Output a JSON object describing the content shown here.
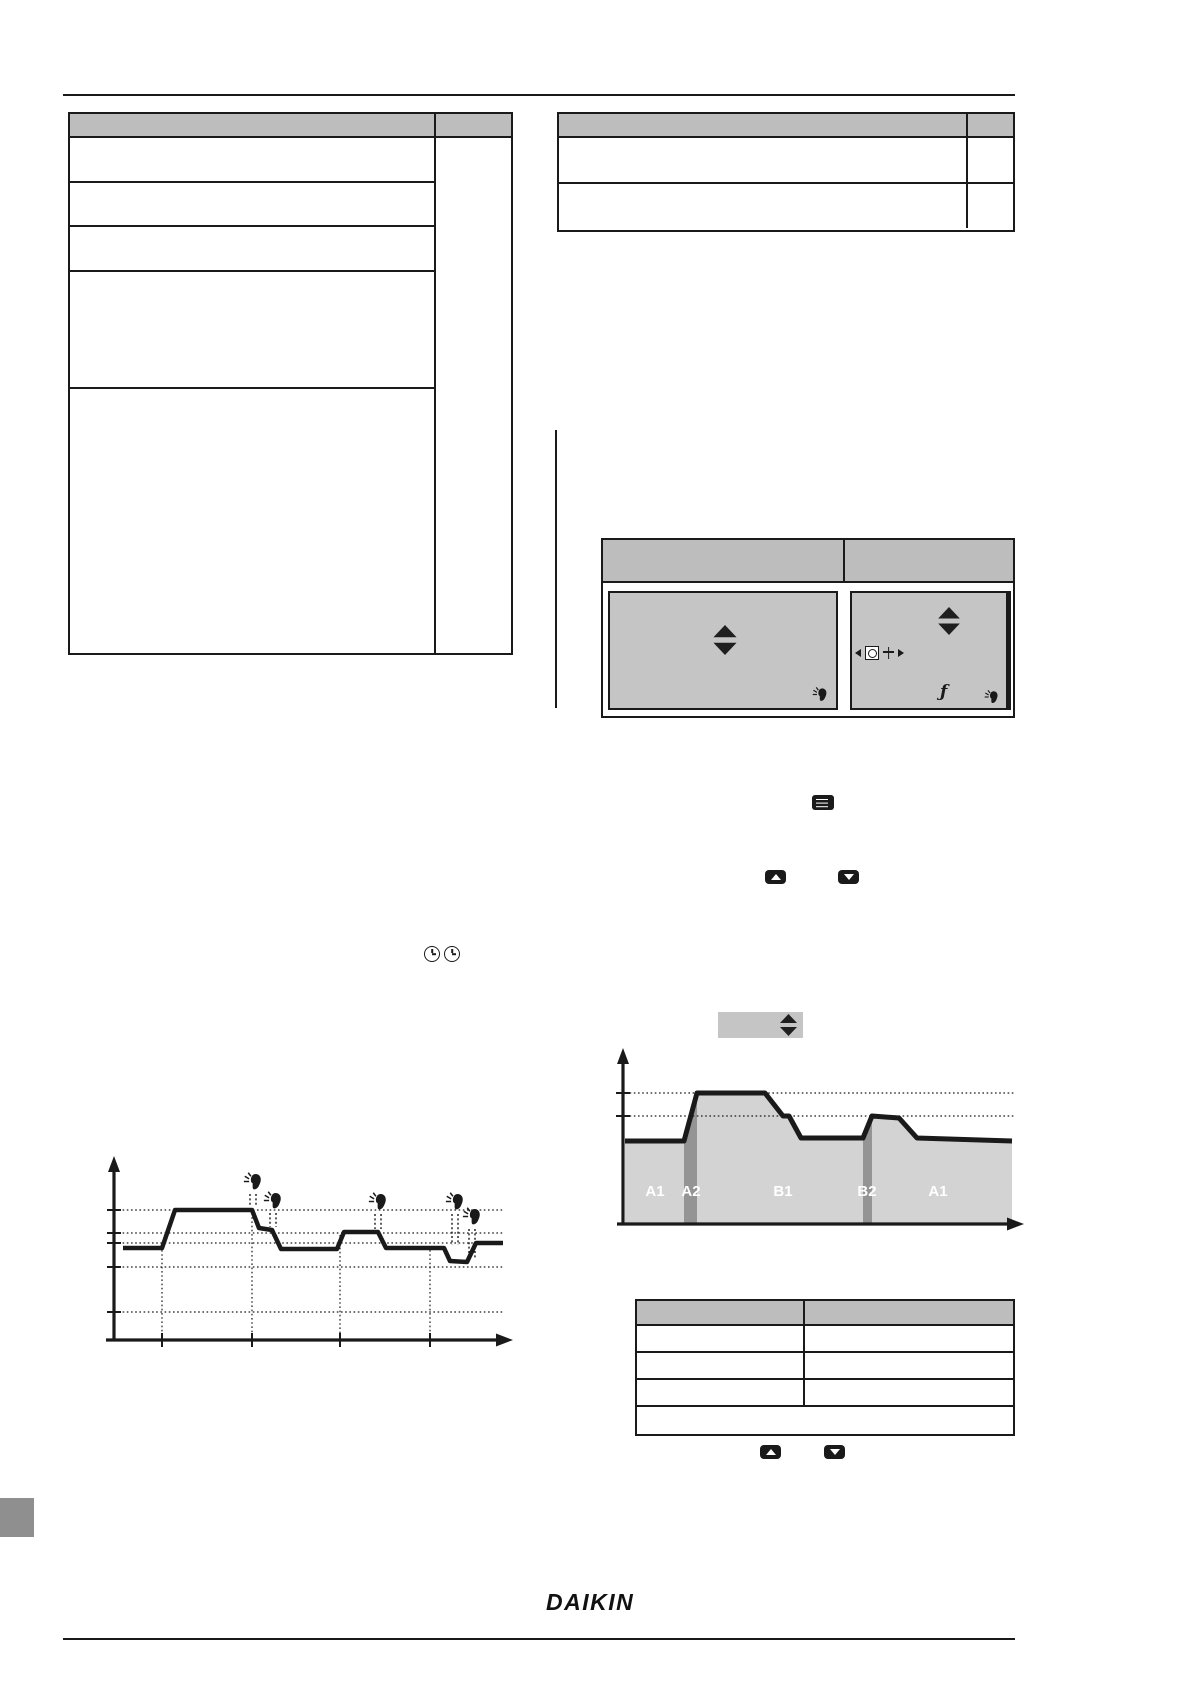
{
  "document": {
    "kind": "operation-manual-page",
    "note": "body text is rendered invisible in the source scan; only frames, figures and icons are visible"
  },
  "colors": {
    "ink": "#1a1a1a",
    "table_header": "#bdbdbd",
    "screen_gray": "#c5c5c5",
    "chart_fill": "#d3d3d3",
    "band_gray": "#949494",
    "white": "#ffffff",
    "thumb_gray": "#8f8f8f"
  },
  "footer": {
    "logo": "DAIKIN"
  },
  "icons": {
    "function_glyph": "ƒ",
    "names": [
      "hand-press-icon",
      "up-down-arrows-icon",
      "up-button-icon",
      "down-button-icon",
      "menu-button-icon",
      "clock-icon",
      "clock-box-icon",
      "program-icon",
      "left-triangle-icon",
      "right-triangle-icon"
    ]
  },
  "tables": {
    "top_left": {
      "columns": 2,
      "left_col_rows": 5,
      "right_col_rows": 1,
      "cells_empty": true
    },
    "top_right": {
      "columns": 2,
      "rows": 2,
      "cells_empty": true
    },
    "screen_figures": {
      "columns": 2,
      "rows": 1,
      "cells_empty": true
    },
    "bottom_right": {
      "columns": 2,
      "rows": 4,
      "cells_empty": true
    }
  },
  "chart_data": [
    {
      "type": "line",
      "name": "room-temperature-schedule-with-manual-overrides",
      "title": "",
      "xlabel": "time",
      "ylabel": "temperature",
      "annotations": "5 hand-press override events with dashed stems down to the curve",
      "grid": "dotted horizontal levels and dotted vertical time marks",
      "geometry": {
        "y_axis": {
          "x": 114,
          "y1": 1156,
          "y2": 1341
        },
        "x_axis": {
          "y": 1340,
          "x1": 106,
          "x2": 513
        },
        "dh_x1": 110,
        "dh_x2": 503,
        "dotted_h": [
          1210,
          1233,
          1243,
          1267,
          1312
        ],
        "ticks_y": [
          1210,
          1233,
          1243,
          1267,
          1312
        ],
        "dotted_v": [
          {
            "x": 162,
            "y1": 1250
          },
          {
            "x": 252,
            "y1": 1213
          },
          {
            "x": 340,
            "y1": 1235
          },
          {
            "x": 430,
            "y1": 1250
          }
        ],
        "ticks_x": [
          162,
          252,
          340,
          430
        ],
        "curve_w": 4.5,
        "curve": [
          [
            123,
            1248
          ],
          [
            162,
            1248
          ],
          [
            175,
            1210
          ],
          [
            252,
            1210
          ],
          [
            259,
            1228
          ],
          [
            272,
            1230
          ],
          [
            281,
            1249
          ],
          [
            337,
            1249
          ],
          [
            344,
            1232
          ],
          [
            378,
            1232
          ],
          [
            386,
            1248
          ],
          [
            444,
            1248
          ],
          [
            450,
            1261
          ],
          [
            467,
            1262
          ],
          [
            476,
            1243
          ],
          [
            503,
            1243
          ]
        ],
        "hands": [
          {
            "x": 253,
            "y": 1182,
            "s1": 1194,
            "s2": 1207
          },
          {
            "x": 273,
            "y": 1201,
            "s1": 1213,
            "s2": 1227
          },
          {
            "x": 378,
            "y": 1202,
            "s1": 1214,
            "s2": 1229
          },
          {
            "x": 455,
            "y": 1202,
            "s1": 1214,
            "s2": 1245
          },
          {
            "x": 472,
            "y": 1217,
            "s1": 1229,
            "s2": 1258
          }
        ]
      }
    },
    {
      "type": "area",
      "name": "schedule-zones-profile",
      "title": "",
      "xlabel": "time",
      "ylabel": "temperature",
      "categories": [
        "A1",
        "A2",
        "B1",
        "B2",
        "A1"
      ],
      "grid": "two dotted setpoint levels",
      "geometry": {
        "box": {
          "x": 718,
          "y": 1012,
          "w": 85,
          "h": 26,
          "ax": 780,
          "ay": 1014
        },
        "y_axis": {
          "x": 623,
          "y1": 1048,
          "y2": 1225
        },
        "x_axis": {
          "y": 1224,
          "x1": 617,
          "x2": 1024
        },
        "dh_x1": 617,
        "dh_x2": 1016,
        "dotted_h": [
          1093,
          1116
        ],
        "ticks_y": [
          1093,
          1116
        ],
        "label_y": 1196,
        "fill": [
          [
            625,
            1141
          ],
          [
            684,
            1141
          ],
          [
            697,
            1093
          ],
          [
            765,
            1093
          ],
          [
            783,
            1116
          ],
          [
            789,
            1116
          ],
          [
            801,
            1138
          ],
          [
            863,
            1138
          ],
          [
            872,
            1116
          ],
          [
            899,
            1118
          ],
          [
            917,
            1138
          ],
          [
            1012,
            1141
          ],
          [
            1012,
            1223
          ],
          [
            625,
            1223
          ]
        ],
        "bands": [
          [
            [
              684,
              1141
            ],
            [
              697,
              1093
            ],
            [
              697,
              1223
            ],
            [
              684,
              1223
            ]
          ],
          [
            [
              863,
              1138
            ],
            [
              872,
              1116
            ],
            [
              872,
              1223
            ],
            [
              863,
              1223
            ]
          ]
        ],
        "curve_w": 5,
        "curve": [
          [
            625,
            1141
          ],
          [
            684,
            1141
          ],
          [
            697,
            1093
          ],
          [
            765,
            1093
          ],
          [
            783,
            1116
          ],
          [
            789,
            1116
          ],
          [
            801,
            1138
          ],
          [
            863,
            1138
          ],
          [
            872,
            1116
          ],
          [
            899,
            1118
          ],
          [
            917,
            1138
          ],
          [
            1012,
            1141
          ]
        ],
        "labels": [
          {
            "t": "A1",
            "x": 655
          },
          {
            "t": "A2",
            "x": 691
          },
          {
            "t": "B1",
            "x": 783
          },
          {
            "t": "B2",
            "x": 867
          },
          {
            "t": "A1",
            "x": 938
          }
        ]
      }
    }
  ]
}
